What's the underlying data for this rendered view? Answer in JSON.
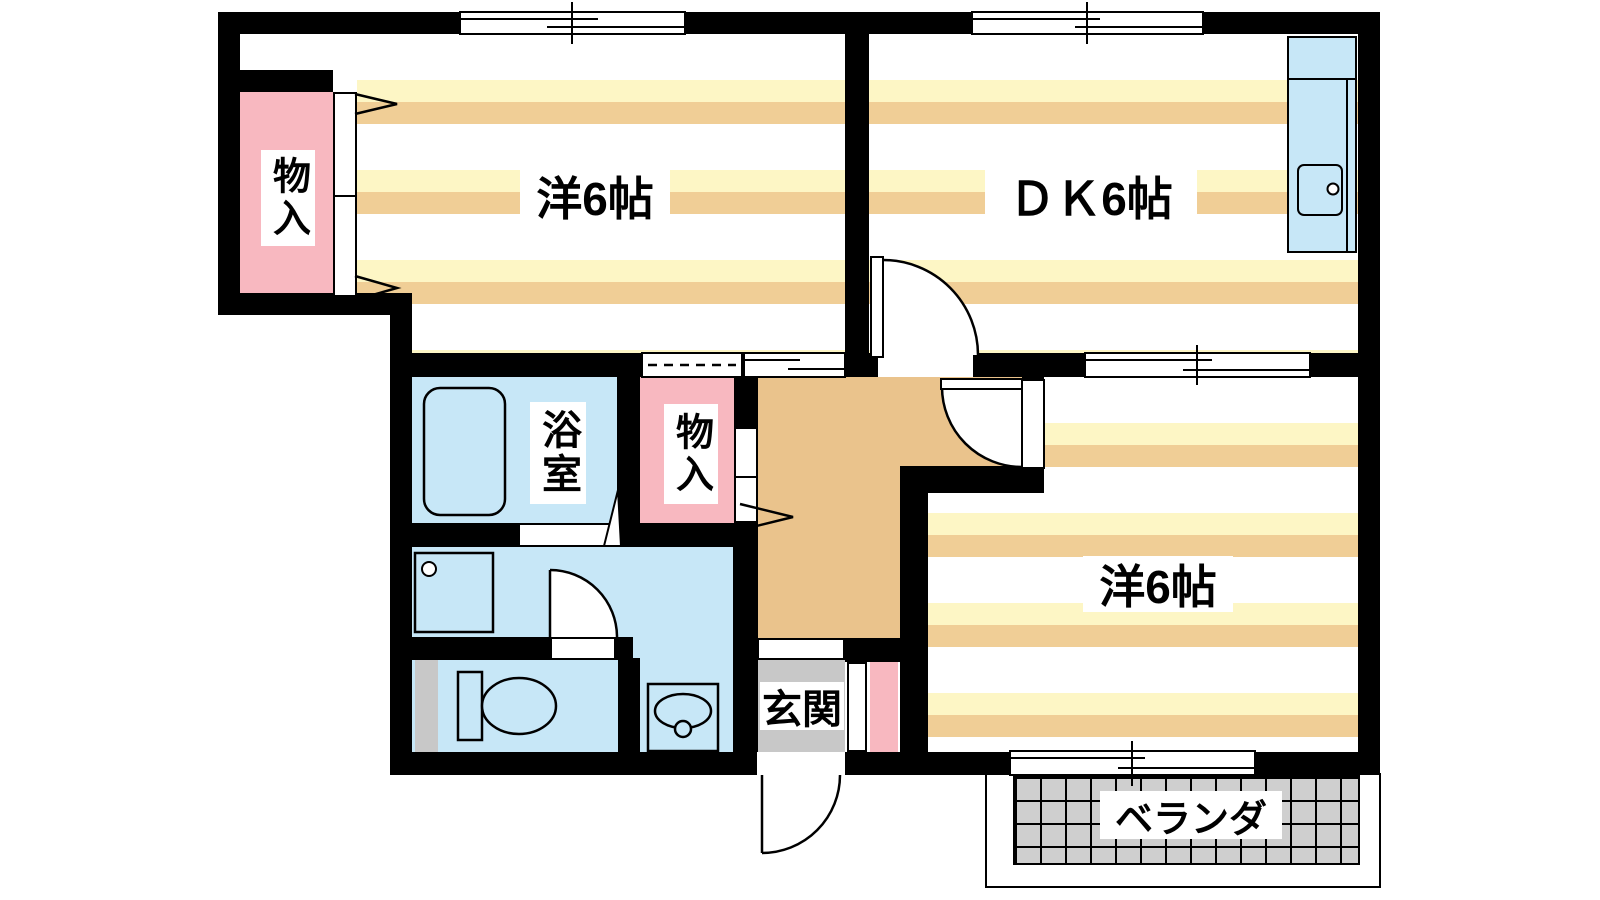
{
  "labels": {
    "room1": "洋6帖",
    "dk": "ＤＫ6帖",
    "room2": "洋6帖",
    "bath": "浴室",
    "closet1": "物入",
    "closet2": "物入",
    "entrance": "玄関",
    "veranda": "ベランダ"
  },
  "colors": {
    "wall": "#000000",
    "stripe_yellow": "#FDF6C5",
    "stripe_tan": "#F0CE96",
    "hallway_tan": "#EAC38C",
    "storage_pink": "#F8B8C0",
    "water_blue": "#C7E7F7",
    "entrance_gray": "#C8C8C8",
    "tile_gray": "#CFCFCF",
    "floor_white": "#FFFFFF"
  }
}
